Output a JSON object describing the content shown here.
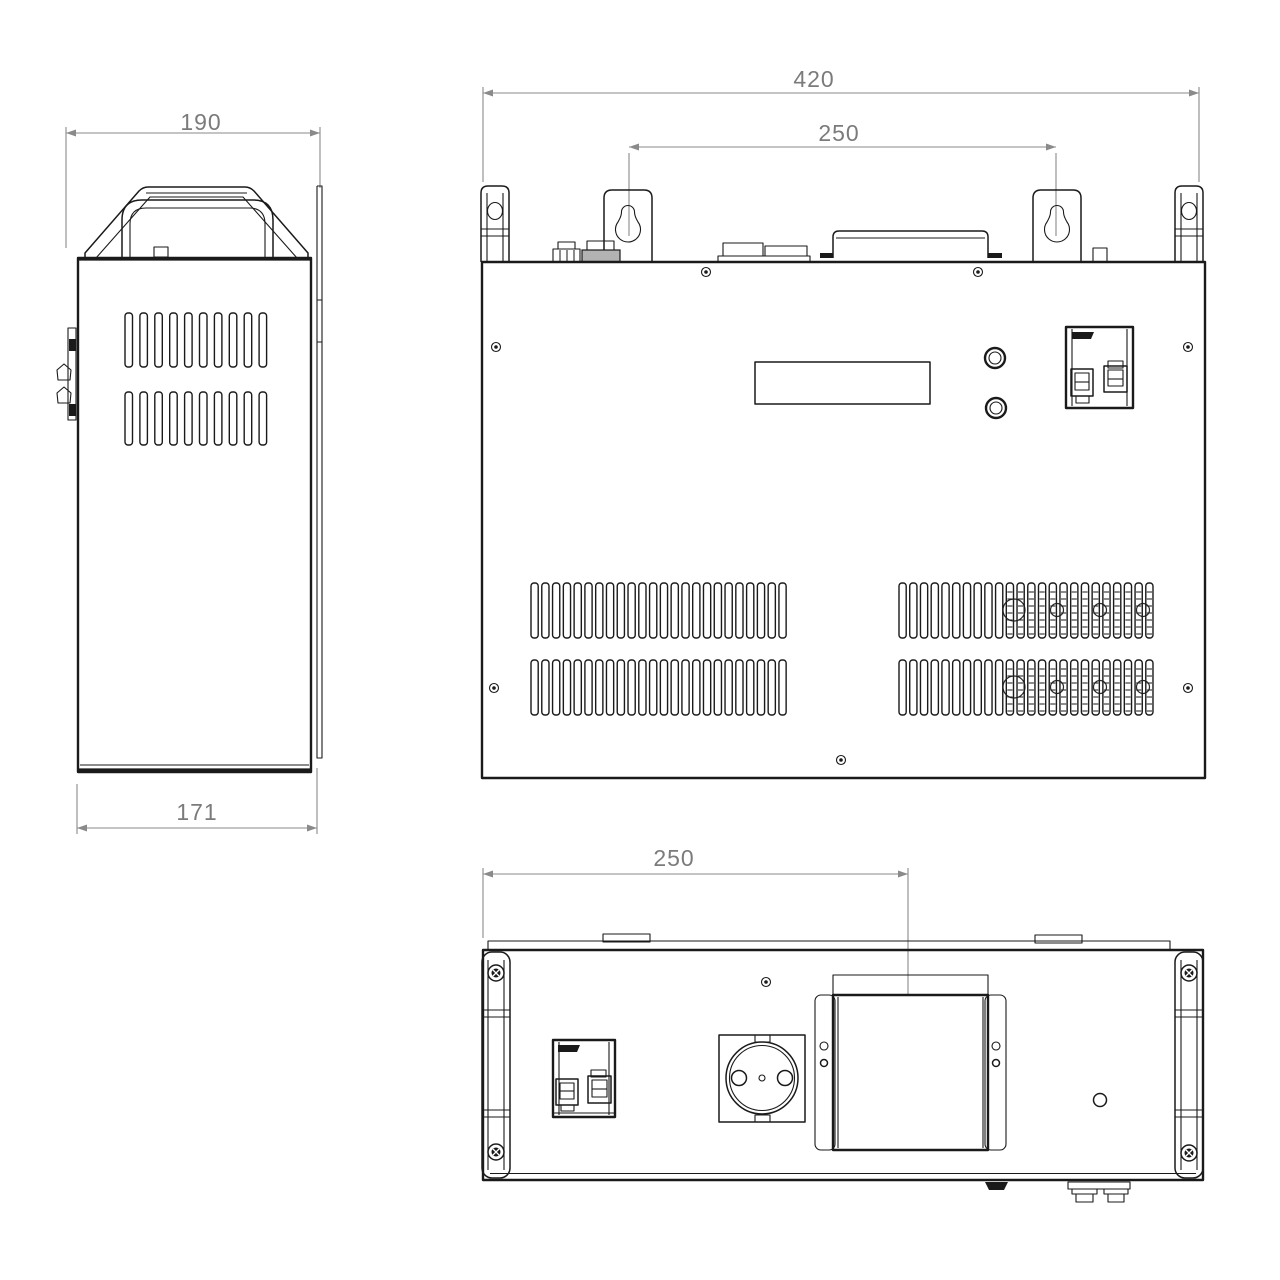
{
  "drawing": {
    "type": "technical-orthographic-views",
    "colors": {
      "line": "#1a1a1a",
      "dimension": "#8a8a8a",
      "background": "#ffffff"
    },
    "dims": {
      "side_width": "190",
      "side_depth": "171",
      "front_width": "420",
      "bracket_spacing": "250",
      "bottom_offset": "250"
    },
    "views": {
      "side": {
        "vent_rows": 2,
        "vent_slots_per_row": 10
      },
      "front": {
        "vent_rows": 2,
        "vent_slots_left": 24,
        "vent_slots_right": 24
      },
      "bottom": {}
    }
  }
}
